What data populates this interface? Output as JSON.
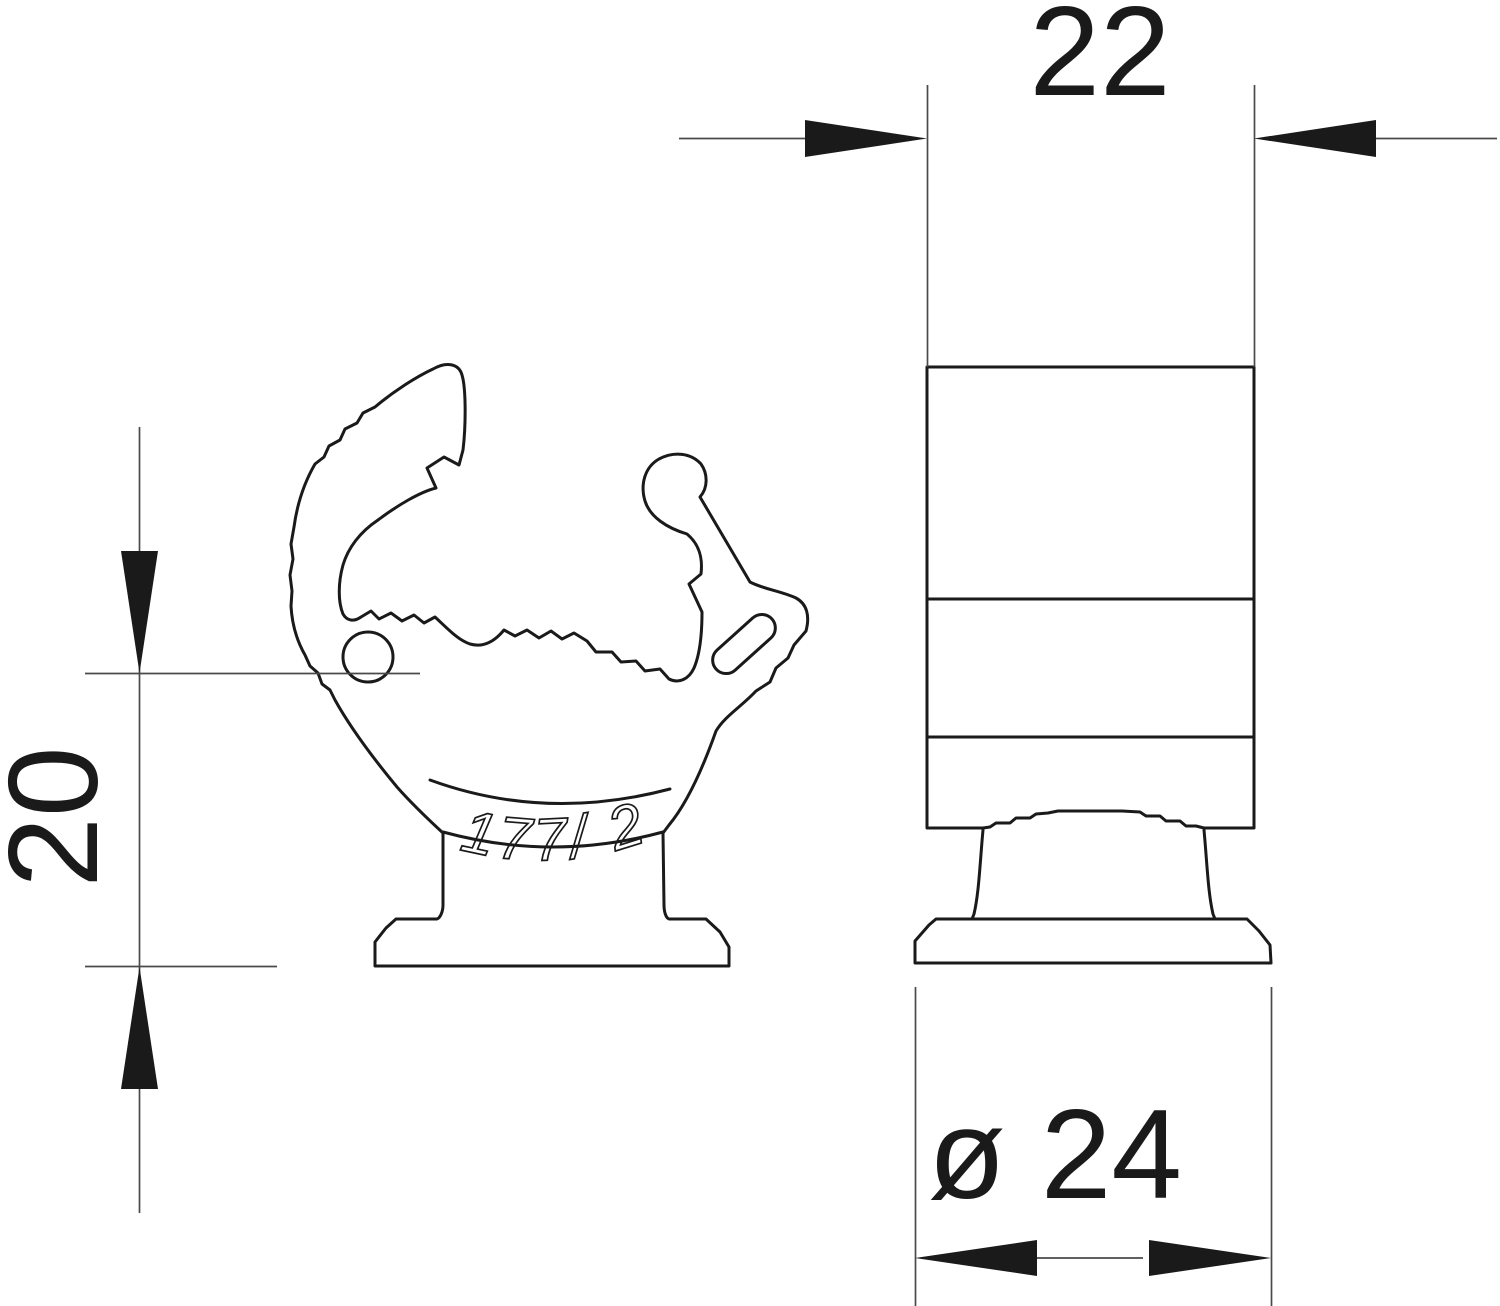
{
  "drawing": {
    "kind": "technical dimension drawing, pipe clip, two views",
    "background": "#ffffff",
    "outline_color": "#1a1a1a",
    "dimension_color": "#4a4a4a"
  },
  "dimensions": {
    "top_width": "22",
    "left_height": "20",
    "base_diameter": "ø 24"
  },
  "marking": "177/ 20"
}
